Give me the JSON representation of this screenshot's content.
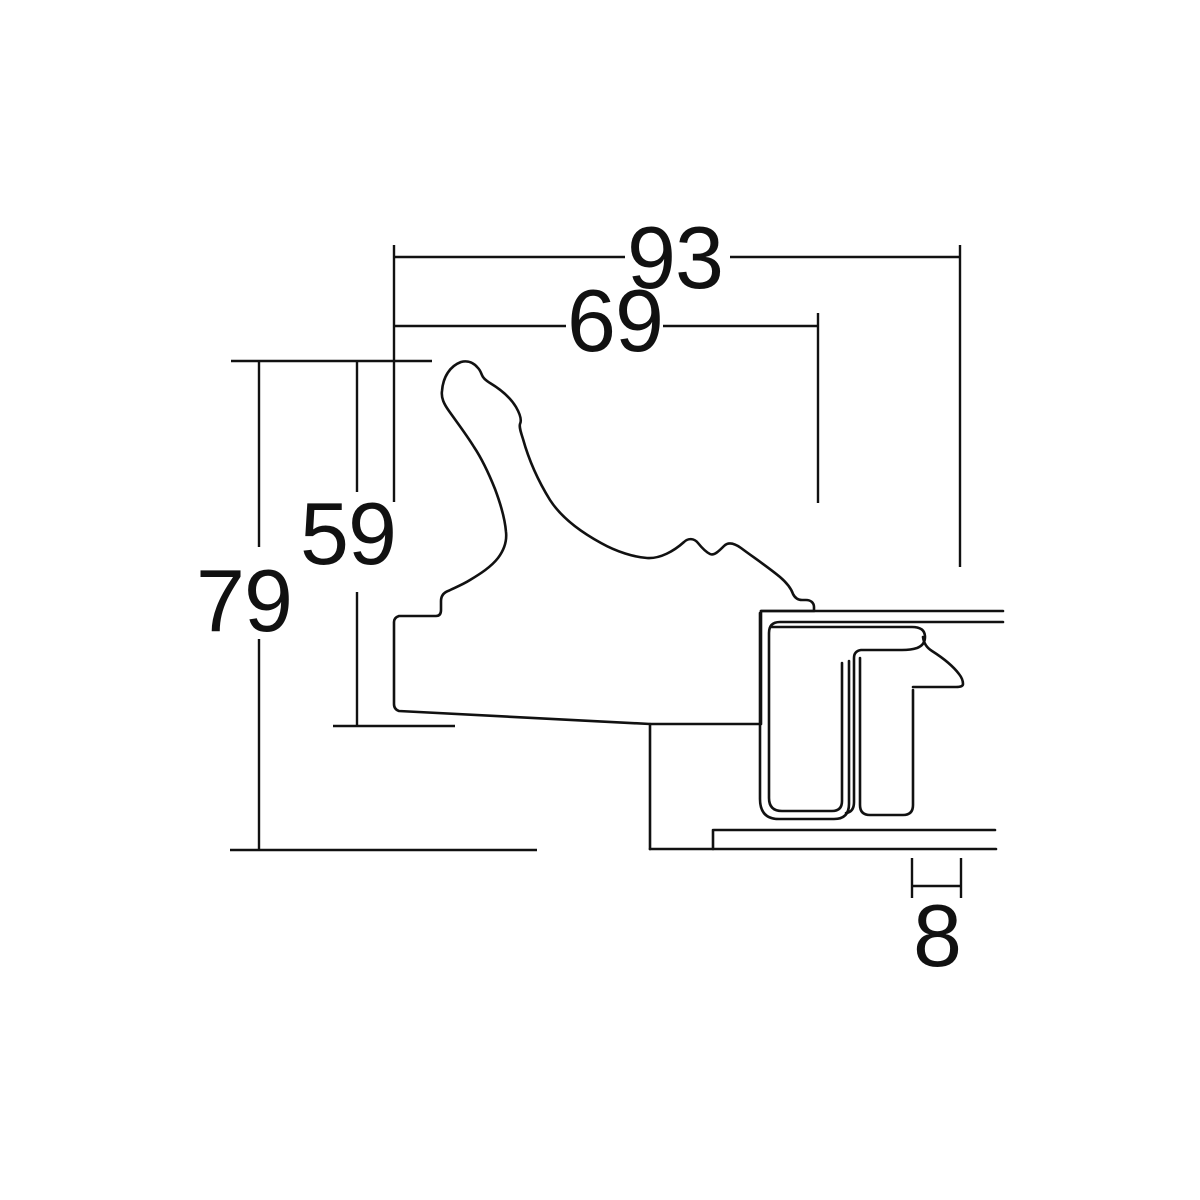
{
  "drawing": {
    "background_color": "#ffffff",
    "line_color": "#111111",
    "dimensions": [
      {
        "id": "overall-depth",
        "value": "93"
      },
      {
        "id": "moulding-width",
        "value": "69"
      },
      {
        "id": "rabbet-height",
        "value": "59"
      },
      {
        "id": "overall-height",
        "value": "79"
      },
      {
        "id": "lip-width",
        "value": "8"
      }
    ]
  }
}
